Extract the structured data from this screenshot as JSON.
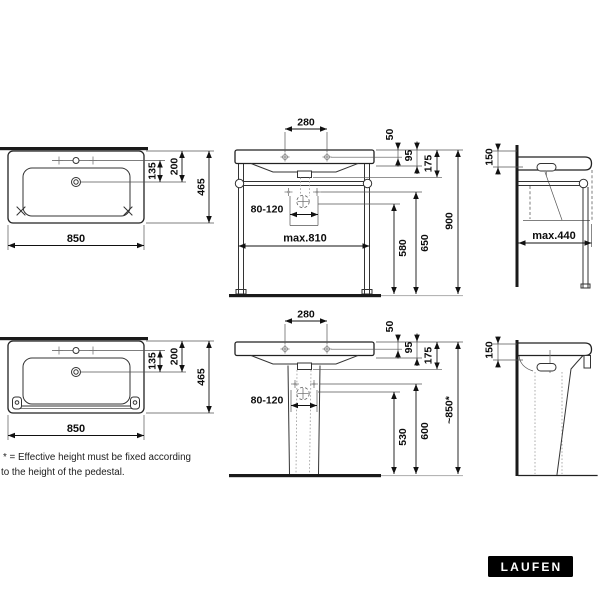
{
  "views": {
    "frame_plan": {
      "width": "850",
      "depth": "465",
      "tap_to_drain": "135",
      "edge_to_drain": "200"
    },
    "frame_front": {
      "tap_spacing": "280",
      "top_offset": "50",
      "rim_height": "95",
      "basin_height": "175",
      "drain_zone": "80-120",
      "frame_width": "max.810",
      "drain_height": "580",
      "fixing_height": "650",
      "total_height": "900"
    },
    "frame_side": {
      "front_clearance": "150",
      "frame_depth": "max.440"
    },
    "pedestal_plan": {
      "width": "850",
      "depth": "465",
      "tap_to_drain": "135",
      "edge_to_drain": "200"
    },
    "pedestal_front": {
      "tap_spacing": "280",
      "top_offset": "50",
      "rim_height": "95",
      "basin_height": "175",
      "drain_zone": "80-120",
      "drain_height": "530",
      "fixing_height": "600",
      "total_height": "~850*"
    },
    "pedestal_side": {
      "front_clearance": "150"
    }
  },
  "footnote": {
    "line1": "* = Effective height must be fixed according",
    "line2": "to the height of the pedestal."
  },
  "logo": {
    "brand": "LAUFEN"
  },
  "colors": {
    "line": "#222222",
    "logo_bg": "#000000",
    "logo_text": "#ffffff"
  }
}
